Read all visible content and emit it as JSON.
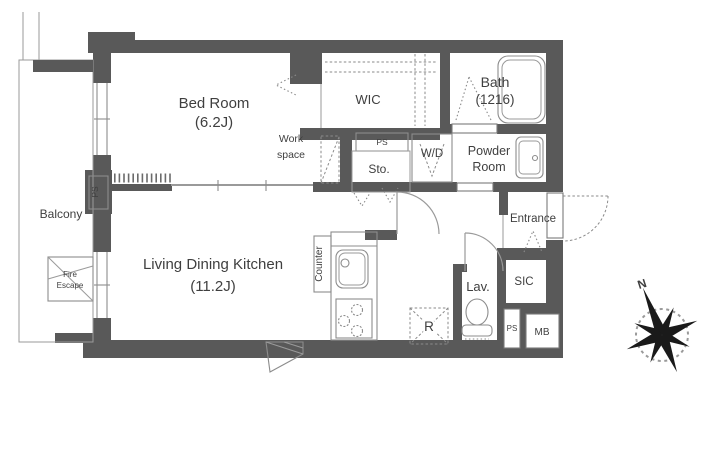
{
  "page": {
    "background": "#ffffff"
  },
  "colors": {
    "wall": "#595959",
    "line": "#8c8c8c",
    "line_light": "#9a9a9a",
    "text": "#3f3f3f",
    "dash": "#8a8a8a"
  },
  "rooms": {
    "bedroom": {
      "name": "Bed Room",
      "size": "(6.2J)"
    },
    "ldk": {
      "name": "Living Dining Kitchen",
      "size": "(11.2J)"
    },
    "wic": {
      "label": "WIC"
    },
    "bath": {
      "name": "Bath",
      "size": "(1216)"
    },
    "powder_room": {
      "line1": "Powder",
      "line2": "Room"
    },
    "laundry": {
      "label": "W/D"
    },
    "storage": {
      "label": "Sto."
    },
    "work_space": {
      "line1": "Work",
      "line2": "space"
    },
    "entrance": {
      "label": "Entrance"
    },
    "sic": {
      "label": "SIC"
    },
    "lavatory": {
      "label": "Lav."
    },
    "balcony": {
      "label": "Balcony"
    },
    "fire_escape": {
      "line1": "Fire",
      "line2": "Escape"
    },
    "counter": {
      "label": "Counter"
    },
    "refrigerator": {
      "label": "R"
    },
    "meter_box": {
      "label": "MB"
    },
    "pipe_shaft_wic": {
      "label": "PS"
    },
    "pipe_shaft_wall": {
      "label": "PS"
    },
    "pipe_shaft_entry": {
      "label": "PS"
    }
  },
  "compass": {
    "north": "N"
  }
}
